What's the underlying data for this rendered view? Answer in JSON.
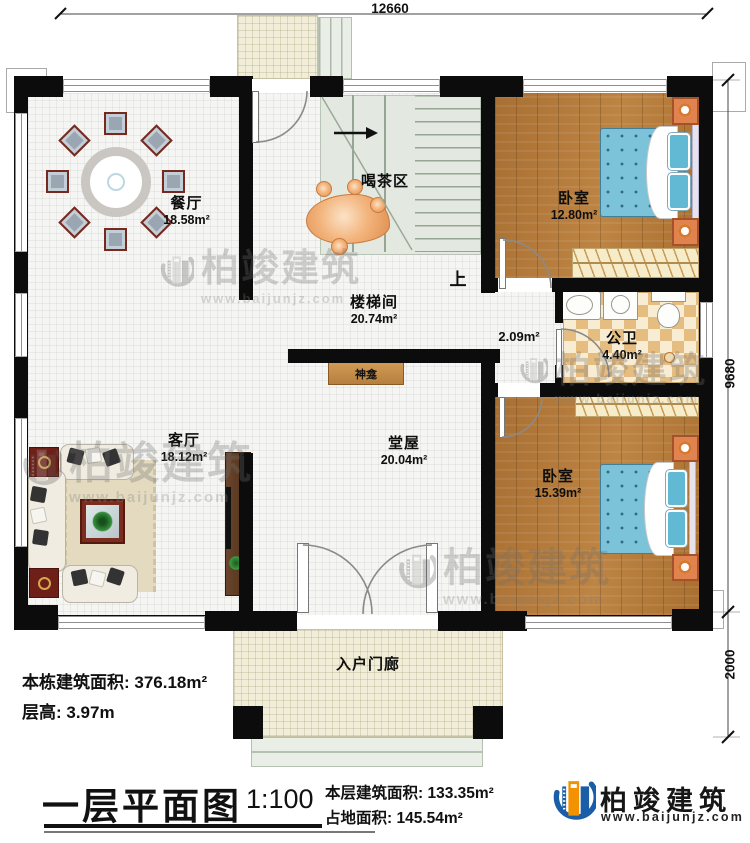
{
  "plan": {
    "dimensions": {
      "width_top": "12660",
      "height_right": "9680",
      "porch_depth": "2000"
    },
    "rooms": {
      "dining": {
        "name": "餐厅",
        "area": "18.58m²"
      },
      "tea": {
        "name": "喝茶区"
      },
      "stairwell": {
        "name": "楼梯间",
        "area": "20.74m²"
      },
      "stairs_up": {
        "label": "上"
      },
      "bedroom1": {
        "name": "卧室",
        "area": "12.80m²"
      },
      "corridor": {
        "area": "2.09m²"
      },
      "bathroom": {
        "name": "公卫",
        "area": "4.40m²"
      },
      "living": {
        "name": "客厅",
        "area": "18.12m²"
      },
      "hall": {
        "name": "堂屋",
        "area": "20.04m²"
      },
      "shrine": {
        "name": "神龛"
      },
      "bedroom2": {
        "name": "卧室",
        "area": "15.39m²"
      },
      "entry_porch": {
        "name": "入户门廊"
      }
    }
  },
  "notes": {
    "building_total_area": "本栋建筑面积: 376.18m²",
    "floor_height": "层高: 3.97m"
  },
  "title_block": {
    "title": "一层平面图",
    "scale": "1:100",
    "floor_area": "本层建筑面积: 133.35m²",
    "footprint_area": "占地面积: 145.54m²"
  },
  "brand": {
    "logo_name": "柏竣建筑",
    "logo_url": "www.baijunjz.com"
  },
  "watermark": {
    "name": "柏竣建筑",
    "url": "www.baijunjz.com"
  },
  "colors": {
    "wall": "#0c0c0c",
    "wood_floor": "#b27a3c",
    "bath_tile_dark": "#e6bd80",
    "bath_tile_light": "#f8edd2",
    "stair": "#e3e9e0",
    "porch": "#f2edd8",
    "bed_blue": "#7cc2d8",
    "furniture_orange": "#e0834e",
    "logo_blue": "#1b5ea8",
    "logo_orange": "#f29200"
  }
}
